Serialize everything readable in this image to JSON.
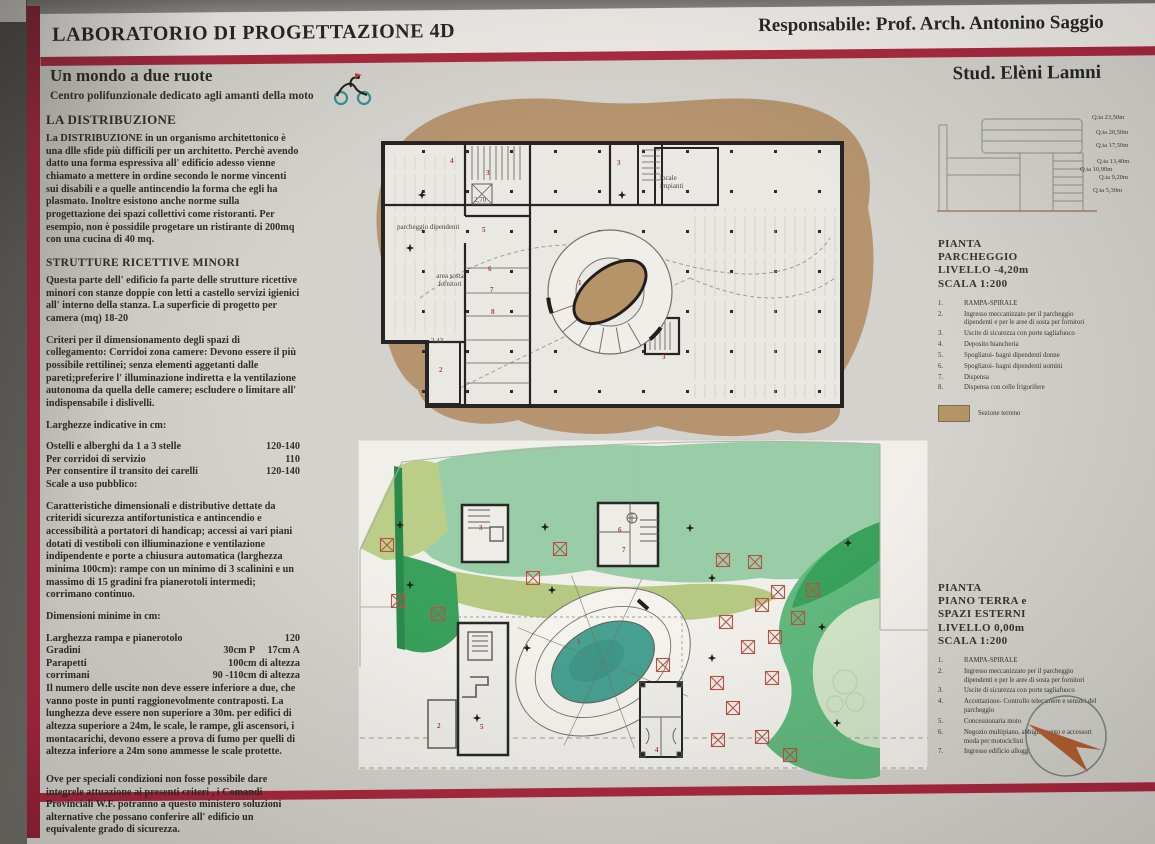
{
  "header": {
    "lab_title": "LABORATORIO DI PROGETTAZIONE 4D",
    "responsible": "Responsabile: Prof. Arch. Antonino Saggio",
    "student": "Stud. Elèni Lamni",
    "project_title": "Un mondo a due ruote",
    "project_subtitle": "Centro polifunzionale dedicato agli amanti della moto"
  },
  "colors": {
    "stripe_red": "#a62038",
    "terrain_brown": "#b18e67",
    "ramp_brown": "#b28e60",
    "pool_teal": "#3e9b8a",
    "green_light": "#93caa2",
    "green_yellow": "#b6cb82",
    "green_dark": "#2e9c52",
    "green_pale": "#cfe3c3",
    "marker_red": "#b5493b",
    "compass_orange": "#b0592a"
  },
  "left_column": {
    "s1_heading": "LA DISTRIBUZIONE",
    "s1_body": "La DISTRIBUZIONE in un organismo architettonico è una dlle sfide più difficili per un architetto. Perchè avendo datto una forma espressiva all' edificio adesso vienne chiamato a mettere in ordine secondo le norme vincenti sui disabili e a quelle antincendio la forma che egli ha plasmato. Inoltre esistono anche norme sulla progettazione dei spazi collettivi come ristoranti. Per esempio, non è possidile progetare un ristirante di 200mq con una cucina di 40 mq.",
    "s2_heading": "STRUTTURE RICETTIVE MINORI",
    "s2_body": "Questa parte dell' edificio fa parte delle strutture ricettive minori con stanze doppie con letti a castello servizi igienici all' interno della stanza. La superficie di progetto per camera (mq) 18-20",
    "criteri_body": "Criteri per il dimensionamento degli spazi di collegamento: Corridoi zona camere: Devono essere il più possibile rettilinei; senza elementi aggetanti dalle pareti;preferire l' illuminazione indiretta e la ventilazione autonoma da quella delle camere; escludere o limitare all' indispensabile i dislivelli.",
    "larghezze_heading": "Larghezze indicative in cm:",
    "larghezze_rows": [
      {
        "label": "Ostelli e alberghi da 1 a 3 stelle",
        "value": "120-140"
      },
      {
        "label": "Per corridoi di servizio",
        "value": "110"
      },
      {
        "label": "Per consentire il transito dei carelli",
        "value": "120-140"
      }
    ],
    "scale_heading": "Scale a uso pubblico:",
    "scale_body": "Caratteristiche dimensionali e distributive dettate da criteridi sicurezza antifortunistica e antincendio e accessibilità a portatori di handicap; accessi ai vari piani  dotati di vestiboli con illiuminazione e ventilazione indipendente e porte a chiusura automatica (larghezza minima 100cm): rampe con un minimo di 3 scalinini e un massimo di 15 gradini fra pianerotoli intermedi; corrimano continuo.",
    "dimensioni_heading": "Dimensioni minime in cm:",
    "dimensioni_rows": [
      {
        "label": "Larghezza rampa e pianerotolo",
        "value": "120"
      },
      {
        "label": "Gradini",
        "value": "30cm P     17cm A"
      },
      {
        "label": "Parapetti",
        "value": "100cm di altezza"
      },
      {
        "label": "corrimani",
        "value": "90 -110cm di altezza"
      }
    ],
    "uscite_body": "Il numero delle uscite non deve essere inferiore a due, che vanno poste in punti raggionevolmente contraposti. La lunghezza deve essere non superiore  a 30m. per edifici di altezza superiore a 24m, le scale, le rampe, gli ascensori, i montacarichi, devono essere a prova di fumo per quelli di altezza inferiore a 24m sono ammesse le scale protette.",
    "ove_body": "Ove per speciali condizioni non fosse possibile dare integrele attuazione ai presenti criteri , i Comandi Provinciali W.F. potranno a questo ministero soluzioni alternative che possano conferire all' edificio un equivalente grado di sicurezza."
  },
  "elevation": {
    "levels": [
      "Q.ta 23,50m",
      "Q.ta 20,50m",
      "Q.ta 17,50m",
      "Q.ta 13,40m",
      "Q.ta 10,90m",
      "Q.ta 9,20m",
      "Q.ta 5,30m"
    ]
  },
  "plans": {
    "parcheggio": {
      "label_parcheggio": "parcheggio dipendenti",
      "label_area": "area sosta\nfornitori",
      "label_locale": "locale\nimpianti",
      "dim_a": "2,70",
      "dim_b": "2,43",
      "rooms": [
        "4",
        "3",
        "3",
        "5",
        "6",
        "7",
        "8",
        "2",
        "1",
        "3"
      ]
    },
    "piano_terra": {
      "rooms": [
        "3",
        "6",
        "7",
        "1",
        "5",
        "2",
        "4"
      ]
    }
  },
  "legend_parcheggio": {
    "title_lines": [
      "PIANTA",
      "PARCHEGGIO",
      "LIVELLO -4,20m",
      "SCALA 1:200"
    ],
    "items": [
      {
        "num": "1.",
        "text": "RAMPA-SPIRALE"
      },
      {
        "num": "2.",
        "text": "Ingresso meccanizzato per il parcheggio dipendenti e per le aree di sosta per fornitori"
      },
      {
        "num": "3.",
        "text": "Uscite di sicurezza con porte tagliafuoco"
      },
      {
        "num": "4.",
        "text": "Deposito biancheria"
      },
      {
        "num": "5.",
        "text": "Spogliatoi- bagni dipendenti donne"
      },
      {
        "num": "6.",
        "text": "Spogliatoi- bagni dipendenti uomini"
      },
      {
        "num": "7.",
        "text": "Dispensa"
      },
      {
        "num": "8.",
        "text": "Dispensa con celle frigorifere"
      }
    ],
    "swatch_label": "Sezione terreno"
  },
  "legend_piano_terra": {
    "title_lines": [
      "PIANTA",
      "PIANO TERRA e",
      "SPAZI ESTERNI",
      "LIVELLO  0,00m",
      "SCALA 1:200"
    ],
    "items": [
      {
        "num": "1.",
        "text": "RAMPA-SPIRALE"
      },
      {
        "num": "2.",
        "text": "Ingresso meccanizzato per il parcheggio dipendenti e per le aree di sosta per fornitori"
      },
      {
        "num": "3.",
        "text": "Uscite di sicurezza con porte tagliafuoco"
      },
      {
        "num": "4.",
        "text": "Accettazione- Controllo telecamere e sensori del parcheggio"
      },
      {
        "num": "5.",
        "text": "Concessionaria moto"
      },
      {
        "num": "6.",
        "text": "Negozio multipiano, abbigliamento e accessori moda per motociclisti"
      },
      {
        "num": "7.",
        "text": "Ingresso edificio alloggi"
      }
    ]
  }
}
